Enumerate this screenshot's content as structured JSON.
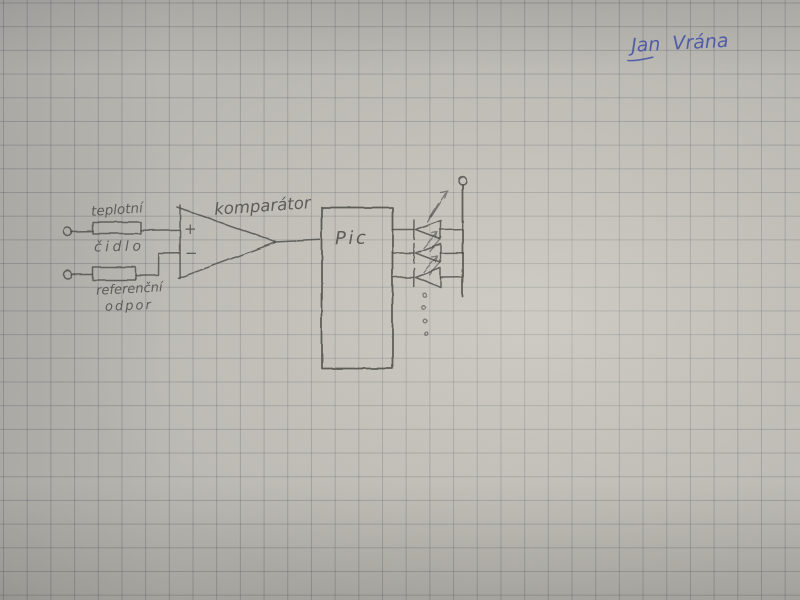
{
  "photo": {
    "paper": {
      "base_color": "#bab8b2",
      "grid_color": "#5a606a",
      "grid_spacing_px": 23.7
    },
    "signature": {
      "text": "Jan Vrána",
      "ink_color": "#4353a6"
    }
  },
  "schematic": {
    "pencil_color": "#4b4a47",
    "labels": {
      "sensor_top": "teplotní",
      "sensor_bottom": "čidlo",
      "reference_top": "referenční",
      "reference_bottom": "odpor",
      "comparator": "komparátor",
      "mcu": "Pic",
      "opamp_plus": "+",
      "opamp_minus": "−"
    },
    "components": {
      "sensor_resistor": "teplotní čidlo",
      "reference_resistor": "referenční odpor",
      "comparator": "komparátor",
      "mcu": "Pic",
      "led_count_drawn": 3,
      "led_continuation_dots": 4,
      "terminal_count": 3
    }
  }
}
